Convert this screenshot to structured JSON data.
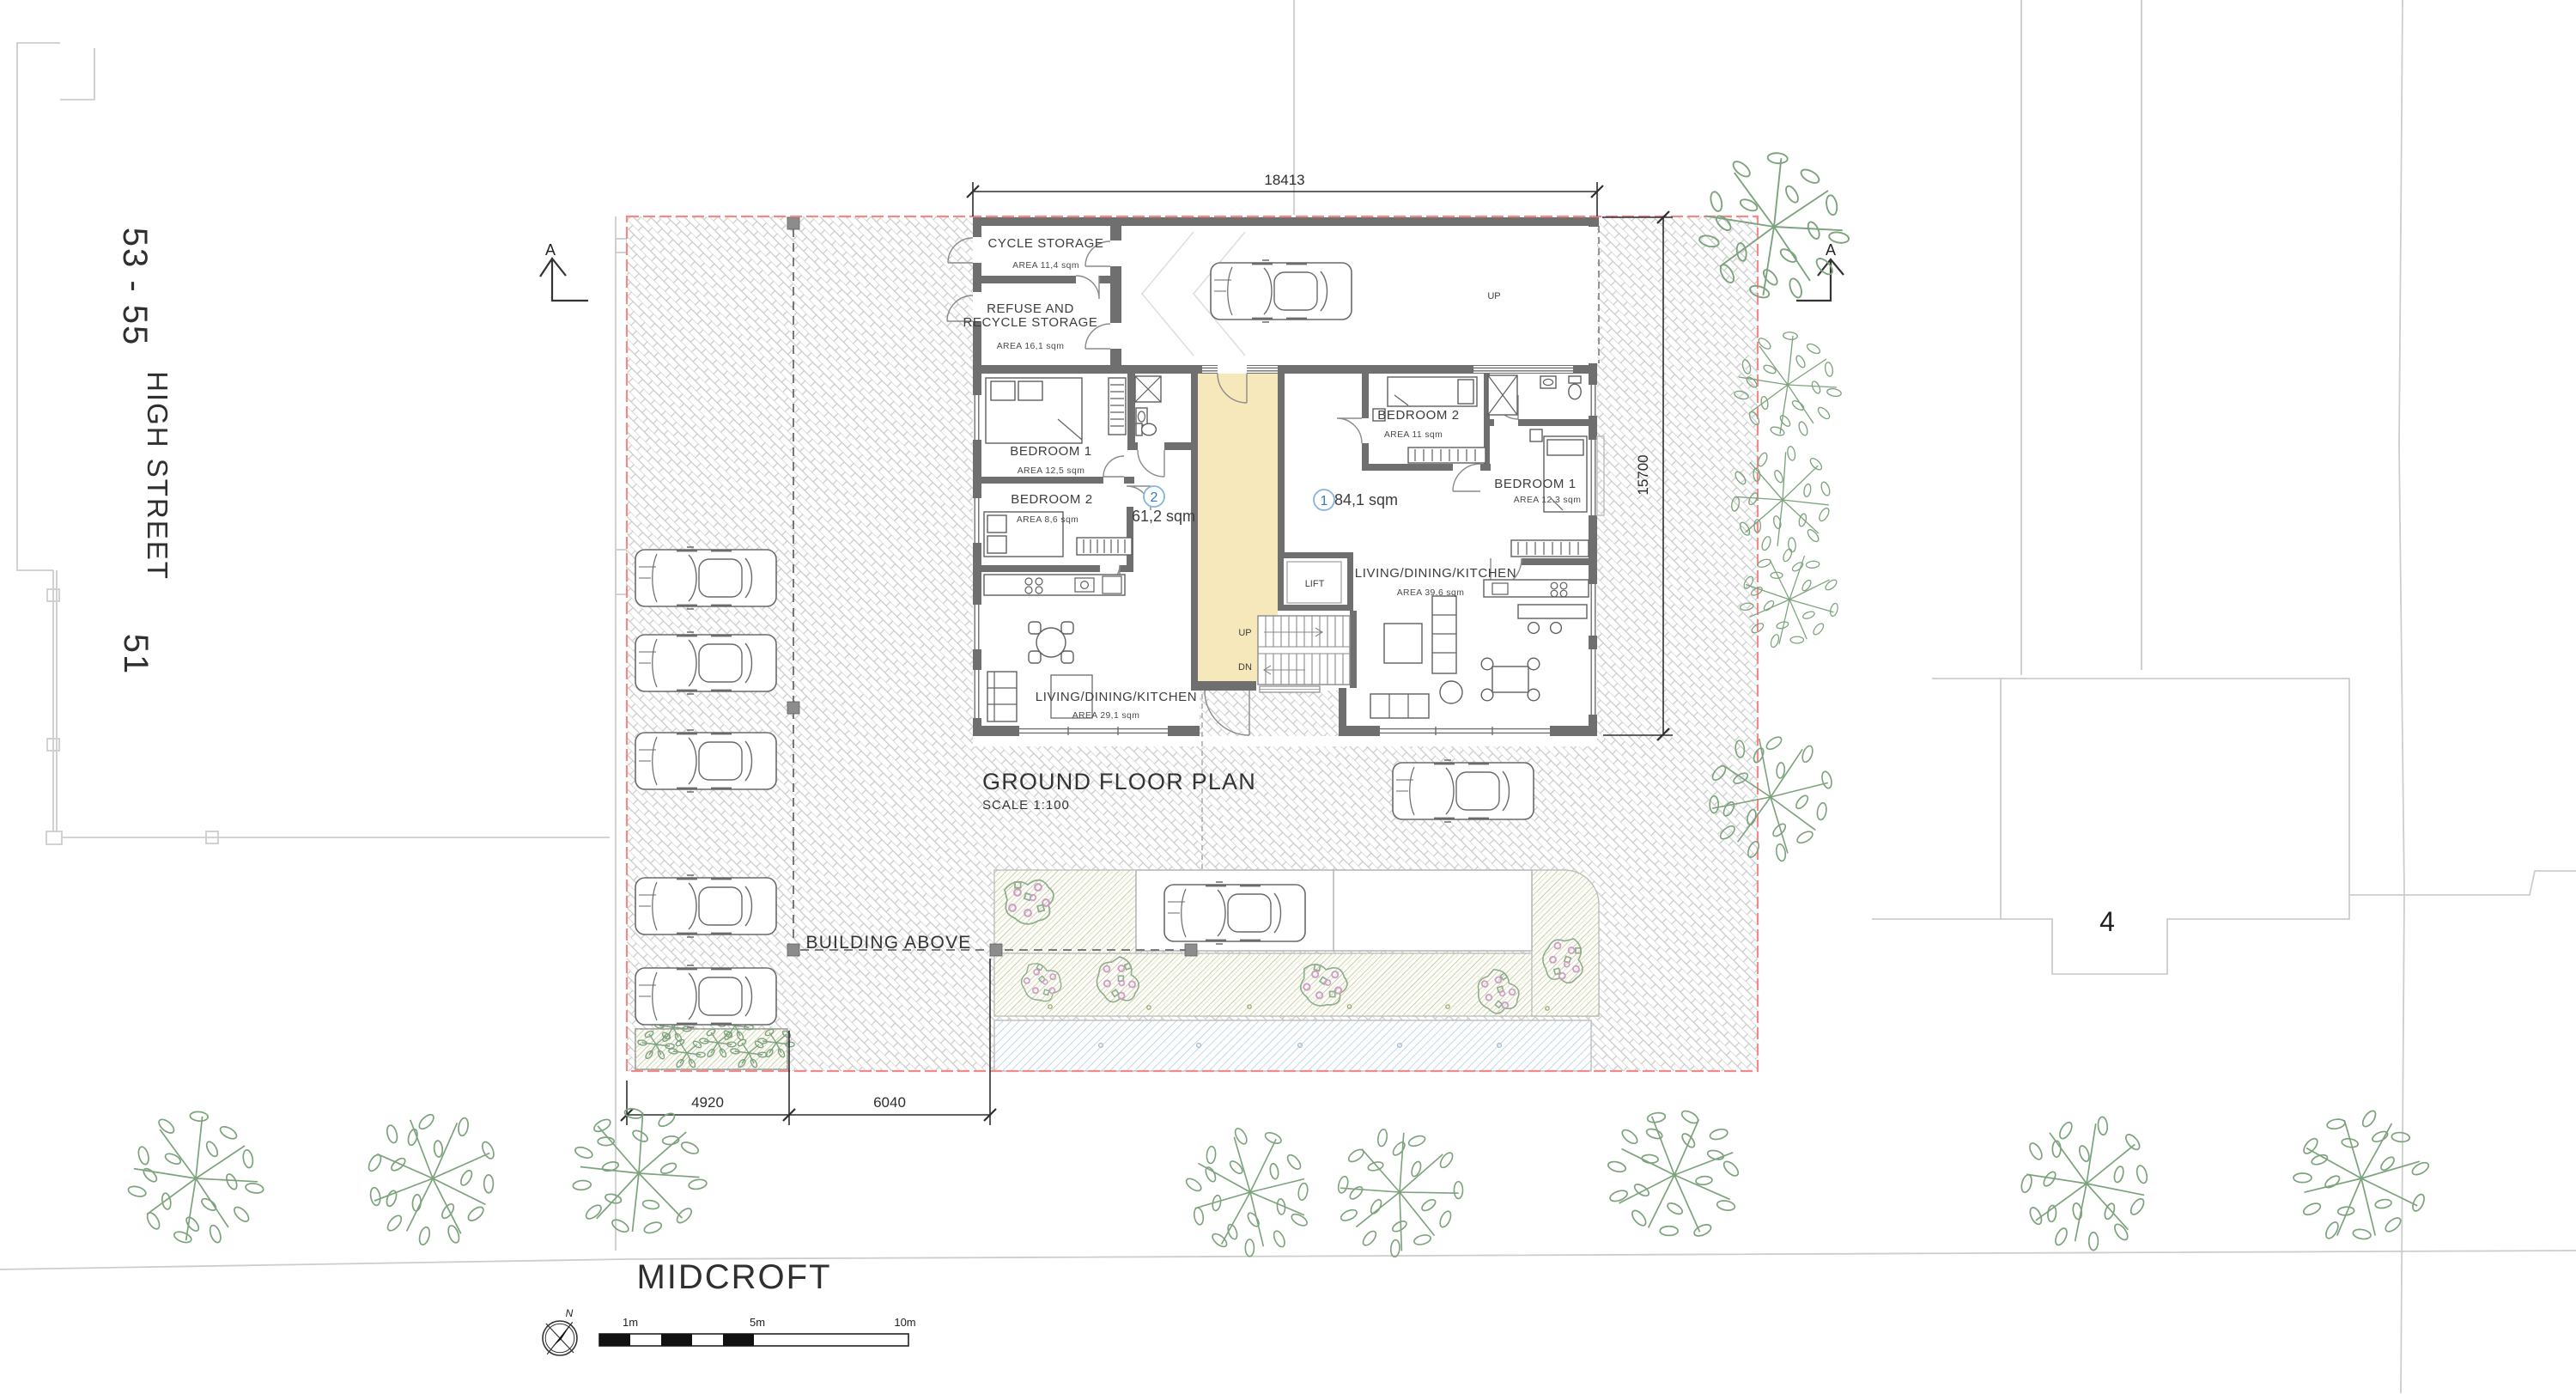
{
  "streets": {
    "numbers_53_55": "53 - 55",
    "high_street": "HIGH STREET",
    "number_51": "51",
    "road_name": "MIDCROFT",
    "neighbor_number": "4"
  },
  "title_block": {
    "title": "GROUND FLOOR PLAN",
    "scale": "SCALE  1:100"
  },
  "annotations": {
    "building_above": "BUILDING ABOVE",
    "section_marker": "A",
    "garage_up": "UP",
    "stairs_up": "UP",
    "stairs_dn": "DN",
    "lift": "LIFT"
  },
  "dimensions": {
    "top_width": "18413",
    "right_height": "15700",
    "bottom_left": "4920",
    "bottom_right": "6040"
  },
  "rooms": {
    "cycle_storage": {
      "name": "CYCLE STORAGE",
      "area": "AREA 11,4 sqm"
    },
    "refuse": {
      "name_line1": "REFUSE AND",
      "name_line2": "RECYCLE STORAGE",
      "area": "AREA 16,1 sqm"
    },
    "flat2": {
      "number": "2",
      "total_area": "61,2 sqm",
      "bedroom1": {
        "name": "BEDROOM 1",
        "area": "AREA 12,5 sqm"
      },
      "bedroom2": {
        "name": "BEDROOM 2",
        "area": "AREA 8,6 sqm"
      },
      "living": {
        "name": "LIVING/DINING/KITCHEN",
        "area": "AREA 29,1 sqm"
      }
    },
    "flat1": {
      "number": "1",
      "total_area": "84,1 sqm",
      "bedroom1": {
        "name": "BEDROOM 1",
        "area": "AREA 12.3 sqm"
      },
      "bedroom2": {
        "name": "BEDROOM 2",
        "area": "AREA 11 sqm"
      },
      "living": {
        "name": "LIVING/DINING/KITCHEN",
        "area": "AREA 39.6 sqm"
      }
    }
  },
  "scale_bar": {
    "m1": "1m",
    "m5": "5m",
    "m10": "10m",
    "north": "N"
  },
  "colors": {
    "boundary_red": "#f28a8a",
    "core_yellow": "#f7e8bb",
    "wall_gray": "#6f6f6f",
    "tree_green": "#7da37d",
    "water_blue": "#a6c6e2",
    "planting_olive": "#bcc289",
    "flat_number_blue": "#2f7cc0",
    "paving_gray": "#c9c9c9"
  }
}
